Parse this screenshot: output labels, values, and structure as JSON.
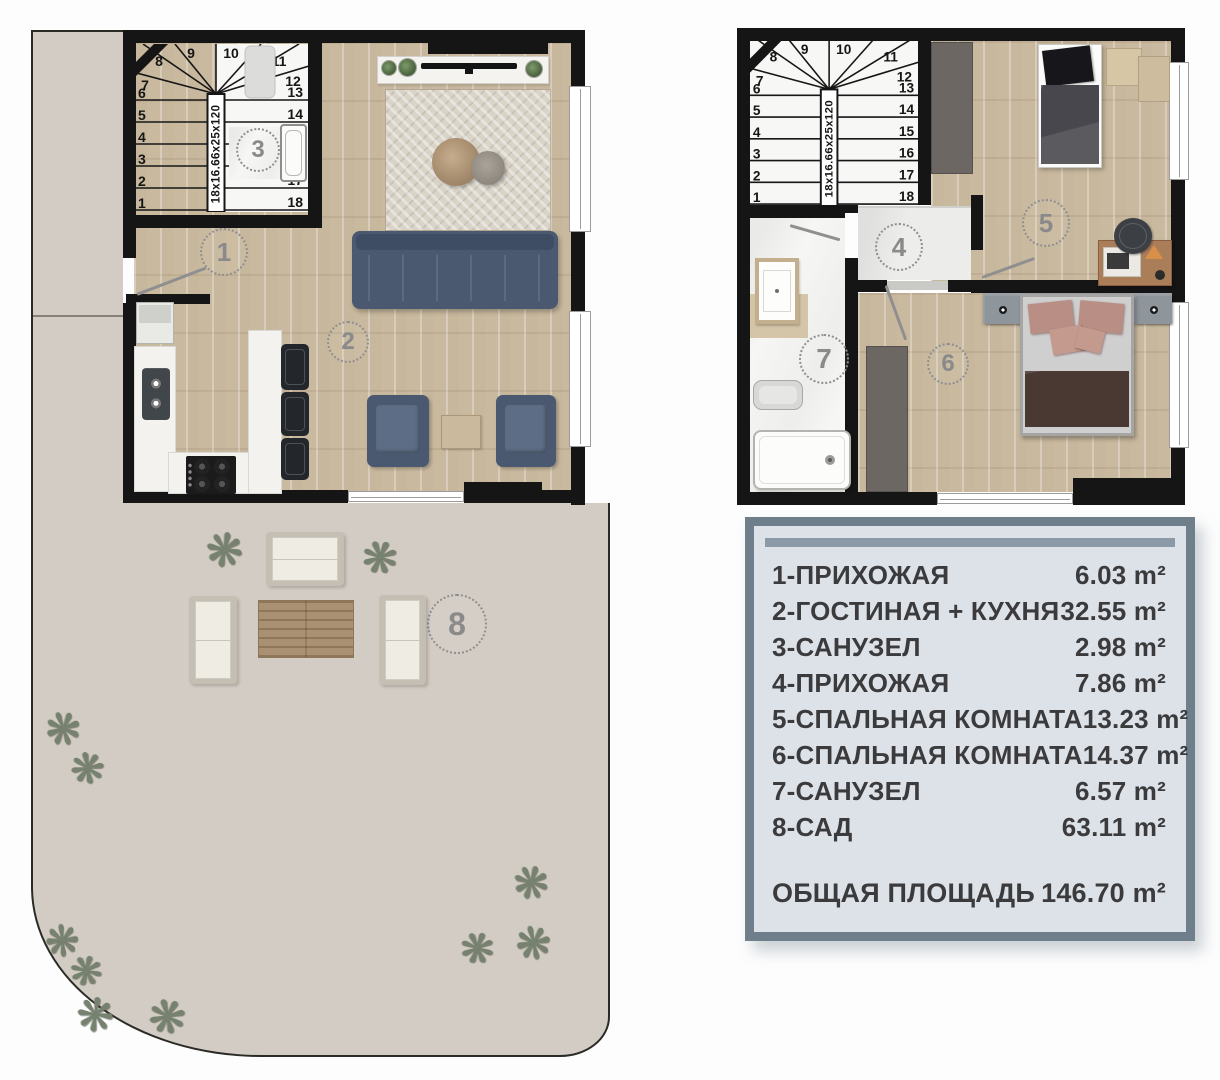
{
  "legend": {
    "rows": [
      {
        "label": "1-ПРИХОЖАЯ",
        "area": "6.03 m²"
      },
      {
        "label": "2-ГОСТИНАЯ + КУХНЯ",
        "area": "32.55 m²"
      },
      {
        "label": "3-САНУЗЕЛ",
        "area": "2.98 m²"
      },
      {
        "label": "4-ПРИХОЖАЯ",
        "area": "7.86 m²"
      },
      {
        "label": "5-СПАЛЬНАЯ КОМНАТА",
        "area": "13.23 m²"
      },
      {
        "label": "6-СПАЛЬНАЯ КОМНАТА",
        "area": "14.37 m²"
      },
      {
        "label": "7-САНУЗЕЛ",
        "area": "6.57 m²"
      },
      {
        "label": "8-САД",
        "area": "63.11 m²"
      }
    ],
    "total_label": "ОБЩАЯ ПЛОЩАДЬ",
    "total_area": "146.70 m²"
  },
  "stairs": {
    "dimension": "18x16.66x25x120",
    "steps": [
      "1",
      "2",
      "3",
      "4",
      "5",
      "6",
      "7",
      "8",
      "9",
      "10",
      "11",
      "12",
      "13",
      "14",
      "15",
      "16",
      "17",
      "18"
    ]
  },
  "markers": {
    "room1": "1",
    "room2": "2",
    "room3": "3",
    "room4": "4",
    "room5": "5",
    "room6": "6",
    "room7": "7",
    "room8": "8"
  },
  "icons": {
    "plant": "❋"
  },
  "colors": {
    "wall": "#151515",
    "wood": "#cec0a7",
    "sofa": "#4a5970",
    "outdoor": "#d3ccc4",
    "legend_border": "#6e7e8a",
    "legend_bg": "#dde2e8"
  }
}
